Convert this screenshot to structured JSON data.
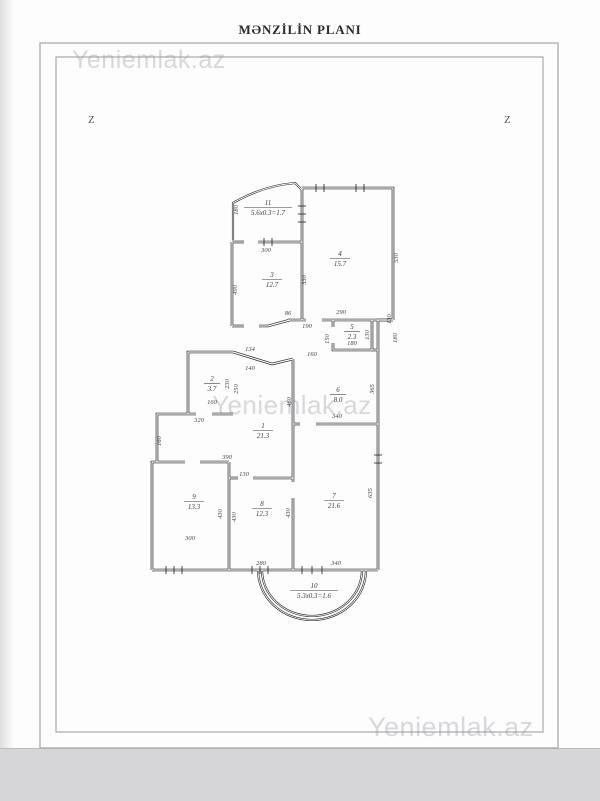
{
  "page": {
    "title": "MƏNZİLİN PLANI",
    "marker_left": "Z",
    "marker_right": "Z"
  },
  "watermarks": {
    "top_left": "Yeniemlak.az",
    "center": "Yeniemlak.az",
    "bottom_right": "Yeniemlak.az"
  },
  "colors": {
    "wall": "#1c1c1f",
    "label": "#3c3c40",
    "dim": "#46464a",
    "frame_outer": "#a6a6ab",
    "frame_inner": "#98989d",
    "watermark": "#d8d8db"
  },
  "plan": {
    "rooms": [
      {
        "n": "1",
        "a": "21.3",
        "x": 263,
        "y": 430
      },
      {
        "n": "2",
        "a": "3.7",
        "x": 212,
        "y": 383
      },
      {
        "n": "3",
        "a": "12.7",
        "x": 272,
        "y": 279
      },
      {
        "n": "4",
        "a": "15.7",
        "x": 340,
        "y": 258
      },
      {
        "n": "5",
        "a": "2.3",
        "x": 352,
        "y": 331
      },
      {
        "n": "6",
        "a": "8.0",
        "x": 338,
        "y": 394
      },
      {
        "n": "7",
        "a": "21.6",
        "x": 334,
        "y": 500
      },
      {
        "n": "8",
        "a": "12.3",
        "x": 262,
        "y": 508
      },
      {
        "n": "9",
        "a": "13.3",
        "x": 194,
        "y": 501
      },
      {
        "n": "10",
        "a": "5.3x0.3=1.6",
        "x": 314,
        "y": 590
      },
      {
        "n": "11",
        "a": "5.6x0.3=1.7",
        "x": 268,
        "y": 207
      }
    ],
    "dimensions": [
      {
        "t": "300",
        "x": 266,
        "y": 252
      },
      {
        "t": "86",
        "x": 288,
        "y": 315
      },
      {
        "t": "290",
        "x": 341,
        "y": 314
      },
      {
        "t": "190",
        "x": 307,
        "y": 328
      },
      {
        "t": "160",
        "x": 312,
        "y": 356
      },
      {
        "t": "134",
        "x": 250,
        "y": 351
      },
      {
        "t": "140",
        "x": 250,
        "y": 370
      },
      {
        "t": "160",
        "x": 212,
        "y": 404
      },
      {
        "t": "320",
        "x": 199,
        "y": 422
      },
      {
        "t": "390",
        "x": 227,
        "y": 459
      },
      {
        "t": "130",
        "x": 244,
        "y": 476
      },
      {
        "t": "300",
        "x": 190,
        "y": 540
      },
      {
        "t": "280",
        "x": 261,
        "y": 565
      },
      {
        "t": "340",
        "x": 336,
        "y": 565
      },
      {
        "t": "340",
        "x": 337,
        "y": 418
      },
      {
        "t": "180",
        "x": 352,
        "y": 345
      },
      {
        "t": "180",
        "x": 238,
        "y": 210,
        "r": -90
      },
      {
        "t": "490",
        "x": 237,
        "y": 290,
        "r": -90
      },
      {
        "t": "330",
        "x": 306,
        "y": 280,
        "r": -90
      },
      {
        "t": "530",
        "x": 398,
        "y": 258,
        "r": -90
      },
      {
        "t": "150",
        "x": 329,
        "y": 339,
        "r": -90
      },
      {
        "t": "130",
        "x": 369,
        "y": 335,
        "r": -90
      },
      {
        "t": "130",
        "x": 391,
        "y": 319,
        "r": -90
      },
      {
        "t": "180",
        "x": 397,
        "y": 338,
        "r": -90
      },
      {
        "t": "365",
        "x": 374,
        "y": 389,
        "r": -90
      },
      {
        "t": "460",
        "x": 291,
        "y": 402,
        "r": -90
      },
      {
        "t": "160",
        "x": 161,
        "y": 441,
        "r": -90
      },
      {
        "t": "230",
        "x": 229,
        "y": 384,
        "r": -90
      },
      {
        "t": "250",
        "x": 238,
        "y": 389,
        "r": -90
      },
      {
        "t": "430",
        "x": 222,
        "y": 514,
        "r": -90
      },
      {
        "t": "430",
        "x": 236,
        "y": 517,
        "r": -90
      },
      {
        "t": "430",
        "x": 290,
        "y": 513,
        "r": -90
      },
      {
        "t": "635",
        "x": 372,
        "y": 493,
        "r": -90
      }
    ]
  }
}
